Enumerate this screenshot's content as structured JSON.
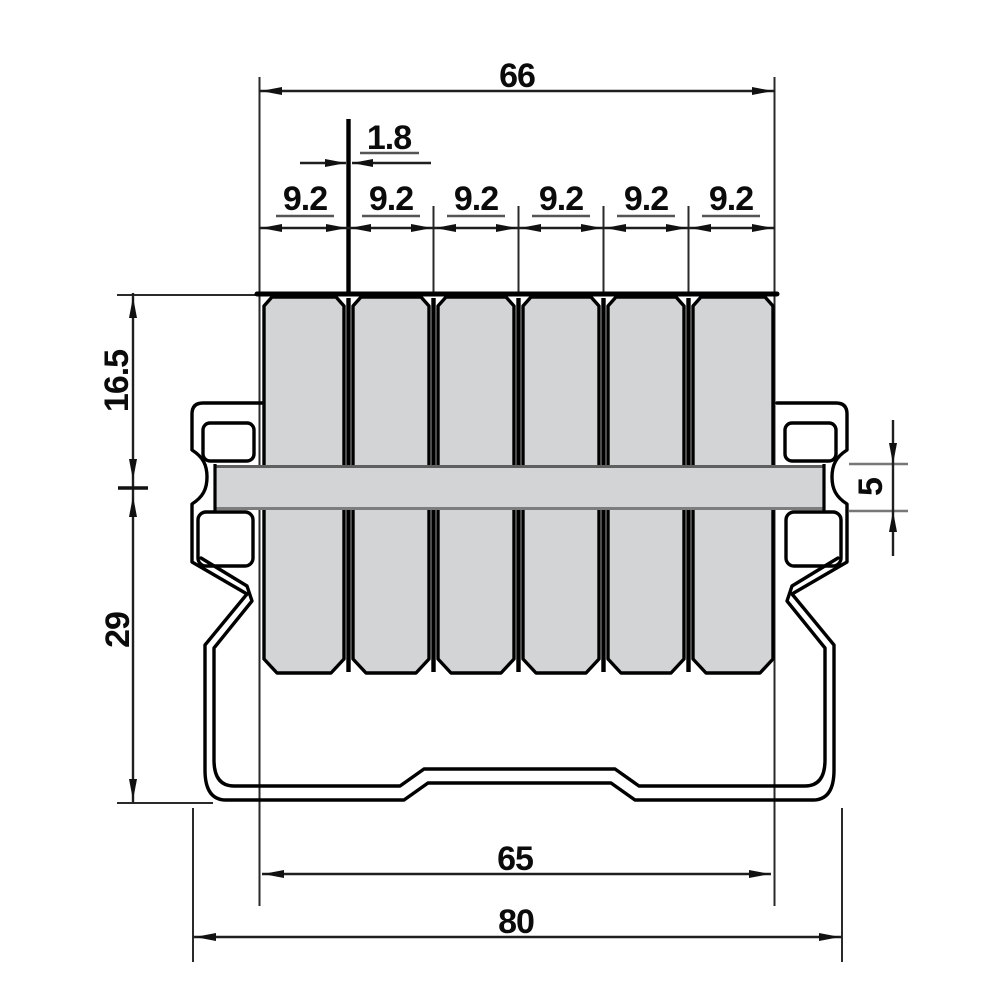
{
  "dims": {
    "overall_top": "66",
    "web_thickness": "1.8",
    "pitches": [
      "9.2",
      "9.2",
      "9.2",
      "9.2",
      "9.2",
      "9.2"
    ],
    "upper_height": "16.5",
    "lower_height": "29",
    "bar_height": "5",
    "inner_bottom": "65",
    "overall_bottom": "80"
  },
  "colors": {
    "cell_fill": "#d3d4d6",
    "bar_fill": "#d3d4d6",
    "outline": "#000000",
    "dim_line": "#1f1f1f",
    "background": "#ffffff"
  }
}
